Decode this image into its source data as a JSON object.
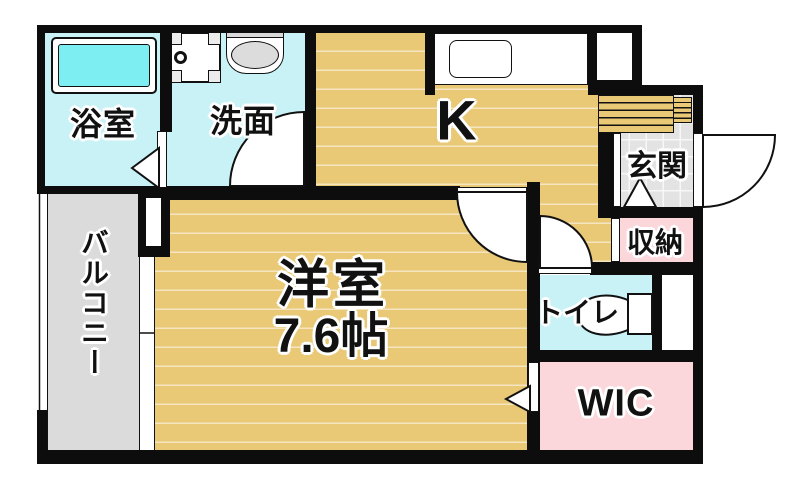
{
  "plan_type": "apartment-floor-plan",
  "rooms": {
    "bathroom": {
      "label": "浴室"
    },
    "washroom": {
      "label": "洗面"
    },
    "kitchen": {
      "label": "K"
    },
    "entrance": {
      "label": "玄関"
    },
    "storage": {
      "label": "収納"
    },
    "toilet": {
      "label": "トイレ"
    },
    "wic": {
      "label": "WIC"
    },
    "western_room": {
      "label": "洋室",
      "size": "7.6帖"
    },
    "balcony": {
      "label": "バルコニー"
    }
  },
  "fixtures": {
    "bathtub": "bathtub-icon",
    "washing_machine_pan": "washing-machine-pan-icon",
    "washbasin": "washbasin-icon",
    "kitchen_sink": "kitchen-sink-icon",
    "toilet_unit": "toilet-icon",
    "entrance_steps": "entrance-steps-icon",
    "sliding_window": "sliding-window-icon"
  },
  "colors": {
    "wall": "#0d0d0d",
    "wood_floor": "#e9c876",
    "wet_area_cyan": "#c9f2f7",
    "bathtub_cyan": "#7deef2",
    "closet_pink": "#fbd6da",
    "balcony_gray": "#dbdbdb",
    "entrance_tile": "#e3e3e3"
  }
}
